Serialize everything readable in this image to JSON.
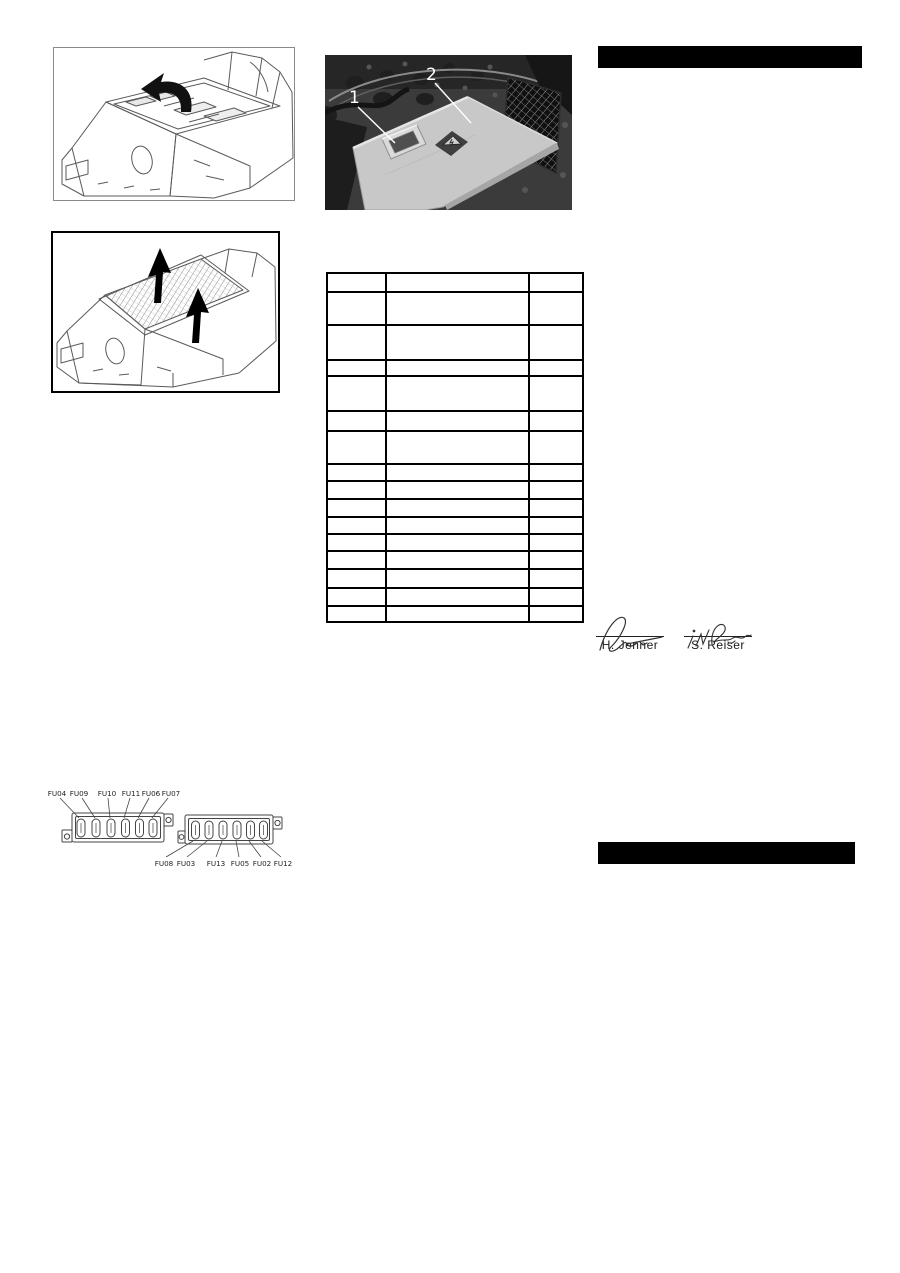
{
  "page": {
    "background": "#ffffff",
    "bar_color": "#000000"
  },
  "figures": {
    "fig1": {
      "description": "line drawing: open machine cover with flip arrow"
    },
    "fig2": {
      "description": "line drawing: lift grid out of machine, two up arrows"
    }
  },
  "photo": {
    "callouts": [
      "1",
      "2"
    ],
    "box_color": "#c8c8c8",
    "background_color": "#3b3b3b"
  },
  "table": {
    "rows": 16,
    "columns": 3,
    "all_cells_empty": true,
    "border_color": "#000000"
  },
  "fuse_diagram": {
    "top_labels": [
      "FU04",
      "FU09",
      "FU10",
      "FU11",
      "FU06",
      "FU07"
    ],
    "bottom_labels": [
      "FU08",
      "FU03",
      "FU13",
      "FU05",
      "FU02",
      "FU12"
    ]
  },
  "signatures": {
    "left": {
      "name": "H. Jenner"
    },
    "right": {
      "name": "S. Reiser"
    }
  }
}
